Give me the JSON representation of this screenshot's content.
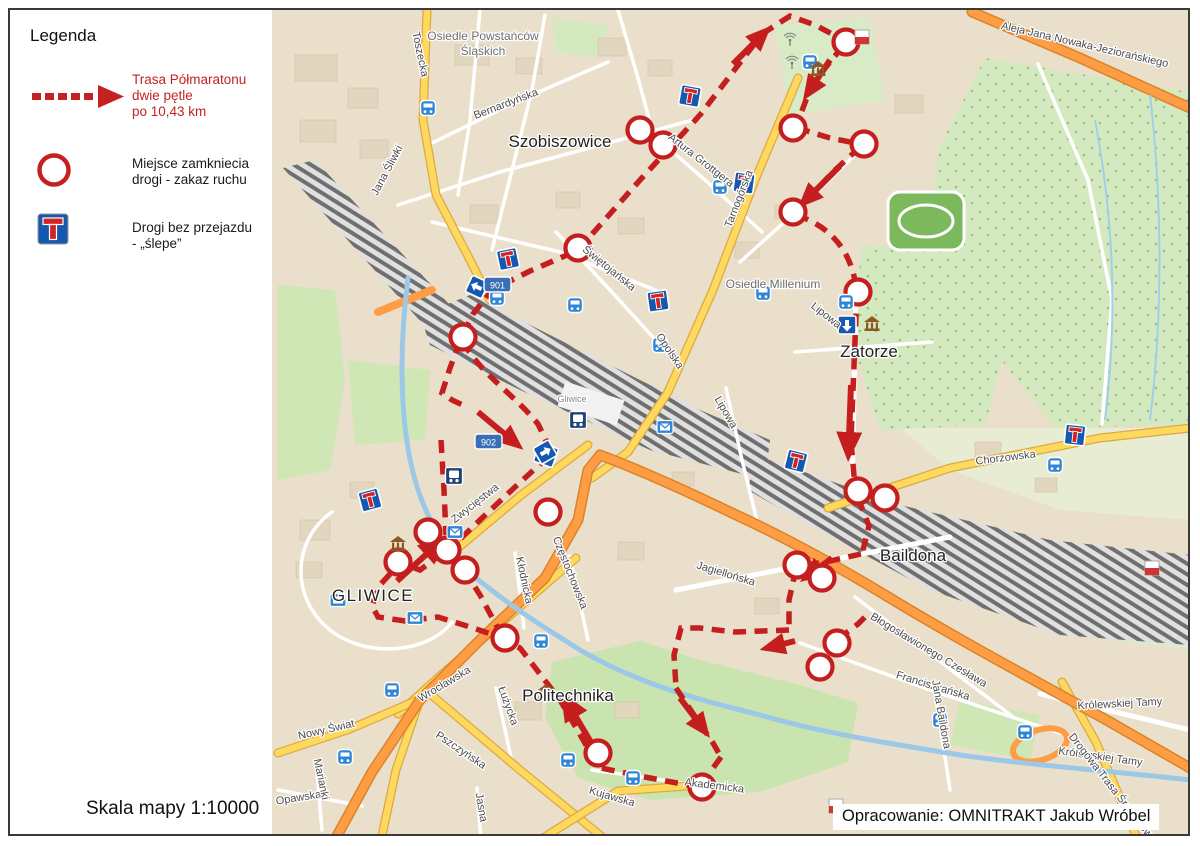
{
  "legend": {
    "title": "Legenda",
    "route_item": {
      "line1": "Trasa Półmaratonu",
      "line2": "dwie pętle",
      "line3": "po 10,43 km"
    },
    "closure_item": {
      "line1": "Miejsce zamkniecia",
      "line2": "drogi - zakaz ruchu"
    },
    "deadend_item": {
      "line1": "Drogi bez przejazdu",
      "line2": "- „ślepe”"
    }
  },
  "footer": {
    "scale": "Skala mapy 1:10000",
    "credit": "Opracowanie: OMNITRAKT Jakub Wróbel"
  },
  "colors": {
    "route": "#c41e1e",
    "road_yellow": "#ffd95f",
    "road_orange": "#ff9d45",
    "water": "#9cc8e8",
    "forest_green": "#d4e9c0",
    "sign_blue": "#1558b0",
    "map_background": "#eadfca"
  },
  "map": {
    "shields": [
      "901",
      "902"
    ],
    "places": [
      "Osiedle Powstańców",
      "Śląskich",
      "Szobiszowice",
      "Osiedle Millenium",
      "Zatorze",
      "Baildona",
      "GLIWICE",
      "Politechnika",
      "Gliwice"
    ],
    "streets": [
      "Toszecka",
      "Jana Śliwki",
      "Bernardyńska",
      "Świętojańska",
      "Artura Grottgera",
      "Tarnogórska",
      "Opolska",
      "Lipowa",
      "Chorzowska",
      "Zwycięstwa",
      "Kłodnicka",
      "Częstochowska",
      "Jagiellońska",
      "Błogosławionego Czesława",
      "Franciszkańska",
      "Wrocławska",
      "Nowy Świat",
      "Łużycka",
      "Pszczyńska",
      "Jasna",
      "Kujawska",
      "Akademicka",
      "Opawska",
      "Marianki",
      "Królewskiej Tamy",
      "Jana Baildona",
      "Aleja Jana Nowaka-Jeziorańskiego",
      "Drogowa Trasa Średnicowa"
    ]
  }
}
